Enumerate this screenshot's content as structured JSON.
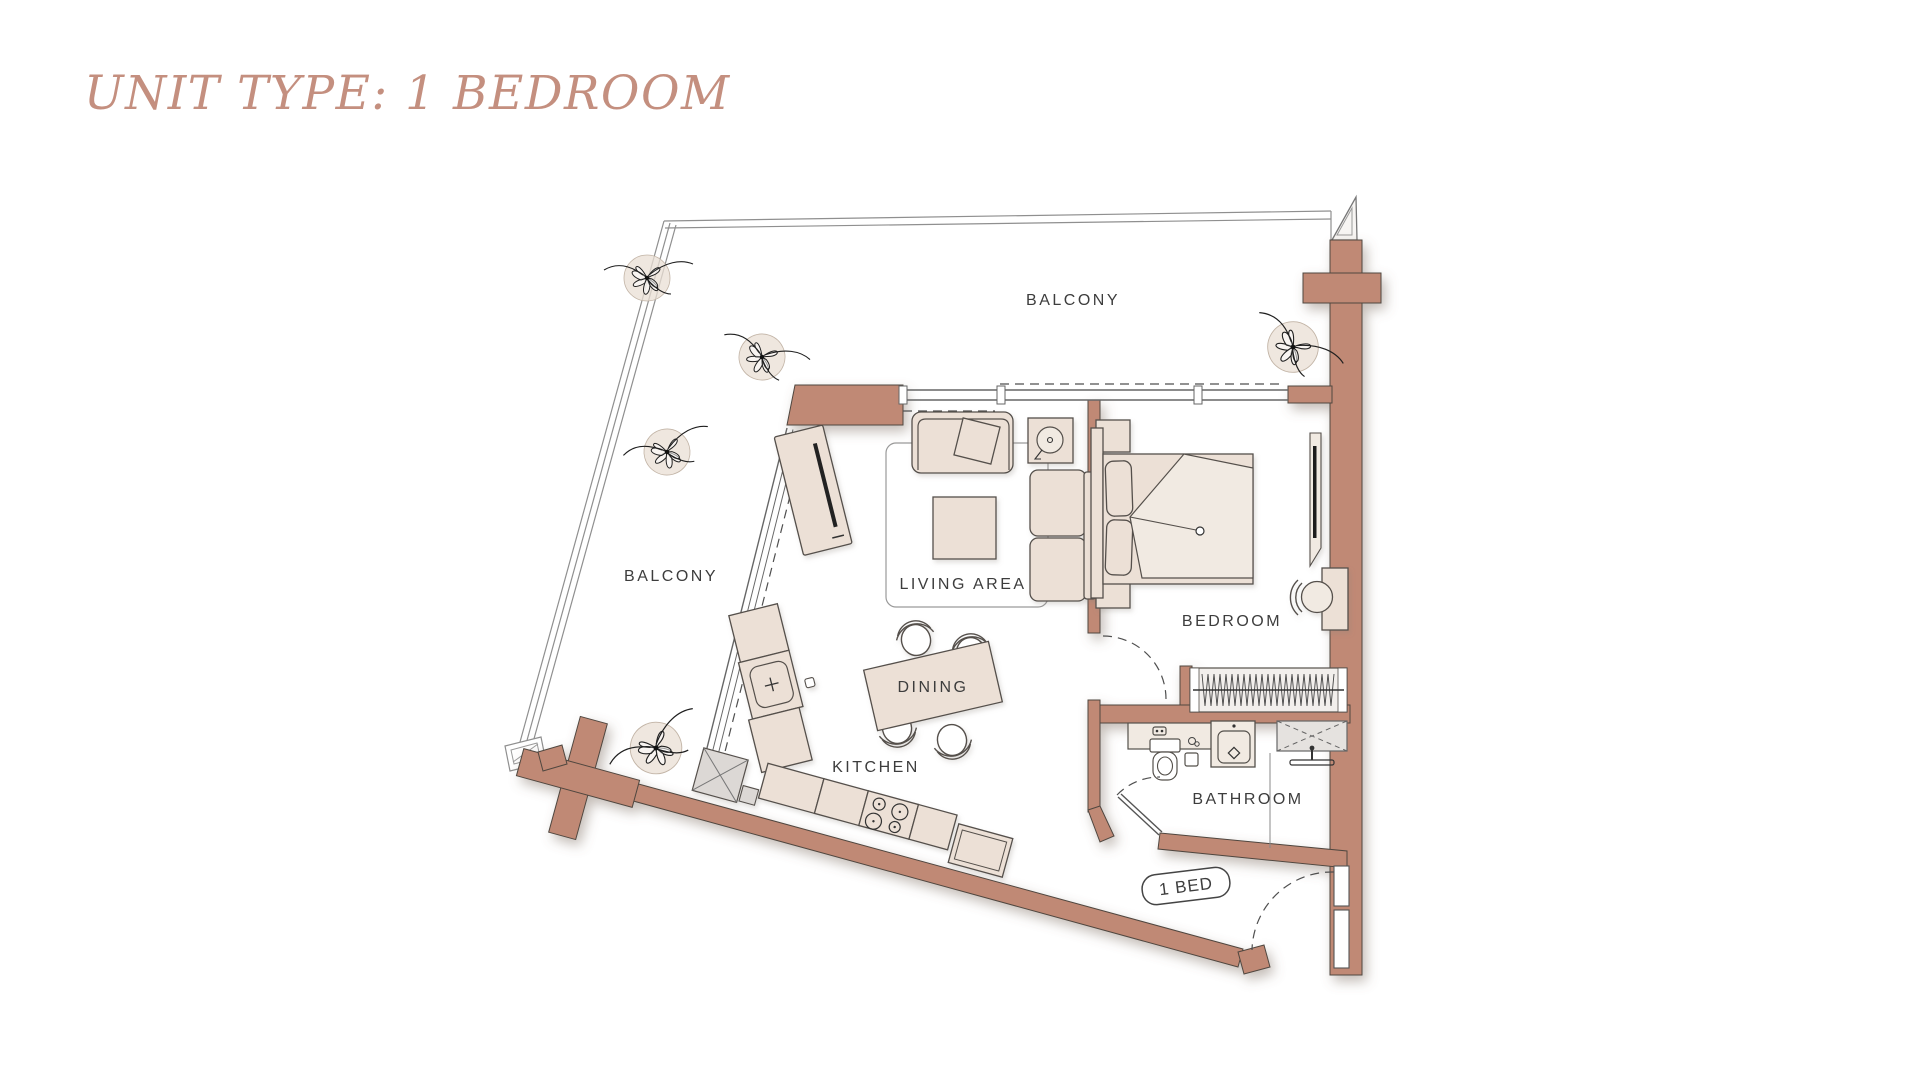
{
  "title": {
    "text": "UNIT TYPE: 1 BEDROOM"
  },
  "floor_plan": {
    "unit_badge": "1 BED",
    "rooms": {
      "balcony_top": "BALCONY",
      "balcony_left": "BALCONY",
      "living": "LIVING AREA",
      "dining": "DINING",
      "kitchen": "KITCHEN",
      "bedroom": "BEDROOM",
      "bathroom": "BATHROOM"
    },
    "colors": {
      "wall": "#c08974",
      "furniture": "#ece0d6",
      "furniture_light": "#f1eae2",
      "outline": "#54504b",
      "rail_gray": "#8f8f8f",
      "label_text": "#3d3d3d",
      "title_text": "#c48f7f"
    }
  }
}
